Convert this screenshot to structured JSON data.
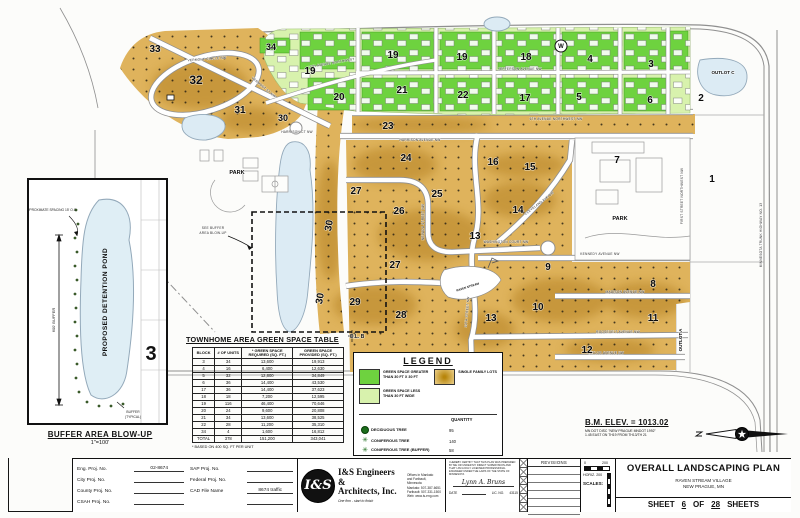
{
  "colors": {
    "gold": "#dfb35c",
    "gold_dark": "#b07d1a",
    "green": "#6ed23f",
    "light_green": "#d8f2ad",
    "pond": "#dcebf4",
    "street_casing": "#8f8f8f"
  },
  "map": {
    "block_labels": [
      {
        "t": "33",
        "x": 155,
        "y": 52
      },
      {
        "t": "32",
        "x": 196,
        "y": 84,
        "s": 12
      },
      {
        "t": "31",
        "x": 240,
        "y": 113
      },
      {
        "t": "30",
        "x": 283,
        "y": 121,
        "s": 9
      },
      {
        "t": "34",
        "x": 271,
        "y": 50,
        "s": 9
      },
      {
        "t": "19",
        "x": 310,
        "y": 74
      },
      {
        "t": "20",
        "x": 339,
        "y": 100
      },
      {
        "t": "21",
        "x": 402,
        "y": 93
      },
      {
        "t": "22",
        "x": 463,
        "y": 98
      },
      {
        "t": "23",
        "x": 388,
        "y": 129
      },
      {
        "t": "19",
        "x": 393,
        "y": 58
      },
      {
        "t": "19",
        "x": 462,
        "y": 60
      },
      {
        "t": "18",
        "x": 526,
        "y": 60
      },
      {
        "t": "4",
        "x": 590,
        "y": 62
      },
      {
        "t": "3",
        "x": 651,
        "y": 67
      },
      {
        "t": "17",
        "x": 525,
        "y": 101
      },
      {
        "t": "5",
        "x": 579,
        "y": 100
      },
      {
        "t": "6",
        "x": 650,
        "y": 103
      },
      {
        "t": "2",
        "x": 701,
        "y": 101
      },
      {
        "t": "OUTLOT C",
        "x": 723,
        "y": 74,
        "s": 4.5
      },
      {
        "t": "24",
        "x": 406,
        "y": 161
      },
      {
        "t": "16",
        "x": 493,
        "y": 165
      },
      {
        "t": "15",
        "x": 530,
        "y": 170
      },
      {
        "t": "27",
        "x": 356,
        "y": 194
      },
      {
        "t": "25",
        "x": 437,
        "y": 197
      },
      {
        "t": "26",
        "x": 399,
        "y": 214
      },
      {
        "t": "14",
        "x": 518,
        "y": 213
      },
      {
        "t": "7",
        "x": 617,
        "y": 163
      },
      {
        "t": "1",
        "x": 712,
        "y": 182
      },
      {
        "t": "13",
        "x": 475,
        "y": 239
      },
      {
        "t": "30",
        "x": 332,
        "y": 226,
        "r": -80
      },
      {
        "t": "27",
        "x": 395,
        "y": 268
      },
      {
        "t": "9",
        "x": 548,
        "y": 270
      },
      {
        "t": "29",
        "x": 355,
        "y": 305
      },
      {
        "t": "28",
        "x": 401,
        "y": 318
      },
      {
        "t": "30",
        "x": 323,
        "y": 299,
        "r": -80
      },
      {
        "t": "13",
        "x": 491,
        "y": 321
      },
      {
        "t": "10",
        "x": 538,
        "y": 310
      },
      {
        "t": "12",
        "x": 587,
        "y": 353
      },
      {
        "t": "8",
        "x": 653,
        "y": 287
      },
      {
        "t": "11",
        "x": 653,
        "y": 321
      },
      {
        "t": "OUTLOT A",
        "x": 682,
        "y": 340,
        "r": -90,
        "s": 4.5
      },
      {
        "t": "PARK",
        "x": 237,
        "y": 174,
        "s": 5.5
      },
      {
        "t": "PARK",
        "x": 620,
        "y": 220,
        "s": 5.5
      },
      {
        "t": "O.L. B",
        "x": 357,
        "y": 338,
        "s": 5
      },
      {
        "t": "RAVEN STREAM",
        "x": 468,
        "y": 288,
        "s": 3,
        "r": -18
      },
      {
        "t": "W",
        "x": 561,
        "y": 48,
        "s": 6
      }
    ],
    "street_labels": [
      {
        "t": "VERMONT CIRCLE NW",
        "x": 207,
        "y": 60,
        "r": -4
      },
      {
        "t": "VERMONT ST NW",
        "x": 263,
        "y": 88,
        "r": 40
      },
      {
        "t": "7TH AVENUE NORTHWEST",
        "x": 332,
        "y": 64,
        "r": -10
      },
      {
        "t": "JEFFERSON AVENUE NW",
        "x": 520,
        "y": 70
      },
      {
        "t": "6TH AVENUE NORTHWEST NW",
        "x": 556,
        "y": 120
      },
      {
        "t": "HARRISON AVENUE NW",
        "x": 420,
        "y": 141
      },
      {
        "t": "HARRISON CT NW",
        "x": 297,
        "y": 133
      },
      {
        "t": "NEVADA STREET NW",
        "x": 424,
        "y": 222,
        "r": -90
      },
      {
        "t": "CLEVELAND AVE NW",
        "x": 540,
        "y": 204,
        "r": -38
      },
      {
        "t": "WASHINGTON COURT NW",
        "x": 506,
        "y": 243
      },
      {
        "t": "KENNEDY AVENUE NW",
        "x": 600,
        "y": 255
      },
      {
        "t": "MADISON AVENUE NW",
        "x": 625,
        "y": 293
      },
      {
        "t": "ROOSEVELT AVENUE NW",
        "x": 618,
        "y": 333
      },
      {
        "t": "TAYLOR AVENUE NW",
        "x": 606,
        "y": 354
      },
      {
        "t": "FIRST STREET NORTHWEST NW",
        "x": 683,
        "y": 196,
        "r": -90
      },
      {
        "t": "MINNESOTA TRUNK HIGHWAY NO. 13",
        "x": 762,
        "y": 235,
        "r": -90
      },
      {
        "t": "10TH STREET NW",
        "x": 468,
        "y": 312,
        "r": -85
      },
      {
        "t": "SEE BUFFER",
        "x": 213,
        "y": 229
      },
      {
        "t": "AREA BLOW-UP",
        "x": 213,
        "y": 234
      }
    ]
  },
  "blowup": {
    "title": "BUFFER AREA BLOW-UP",
    "scale": "1\"=100'",
    "pond_label": "PROPOSED DETENTION POND",
    "spacing_label": "APPROXIMATE SPACING 15' O.C.",
    "dim_label": "600' BUFFER",
    "buffer_label_1": "BUFFER",
    "buffer_label_2": "(TYPICAL)",
    "block_number": "3"
  },
  "table": {
    "title": "TOWNHOME AREA GREEN SPACE TABLE",
    "headers": [
      "BLOCK",
      "# OF UNITS",
      "* GREEN SPACE REQUIRED (SQ. FT.)",
      "GREEN SPACE PROVIDED (SQ. FT.)"
    ],
    "rows": [
      [
        "3",
        "34",
        "13,600",
        "19,913"
      ],
      [
        "4",
        "16",
        "6,400",
        "12,630"
      ],
      [
        "5",
        "32",
        "12,800",
        "34,849"
      ],
      [
        "6",
        "36",
        "14,400",
        "43,530"
      ],
      [
        "17",
        "36",
        "14,400",
        "37,623"
      ],
      [
        "18",
        "18",
        "7,200",
        "12,595"
      ],
      [
        "19",
        "116",
        "46,400",
        "70,646"
      ],
      [
        "20",
        "24",
        "9,600",
        "20,808"
      ],
      [
        "21",
        "34",
        "13,600",
        "38,525"
      ],
      [
        "22",
        "28",
        "11,200",
        "35,310"
      ],
      [
        "34",
        "4",
        "1,600",
        "16,812"
      ],
      [
        "TOTAL",
        "378",
        "151,200",
        "343,041"
      ]
    ],
    "footnote": "* BASED ON 400 SQ. FT PER UNIT"
  },
  "legend": {
    "title": "LEGEND",
    "items": [
      {
        "icon": "green-space-swatch",
        "line1": "GREEN SPACE GREATER",
        "line2": "THAN 30 FT X 30 FT"
      },
      {
        "icon": "light-green-space-swatch",
        "line1": "GREEN SPACE LESS",
        "line2": "THAN 30 FT WIDE"
      },
      {
        "icon": "single-family-swatch",
        "line1": "SINGLE FAMILY LOTS",
        "line2": ""
      }
    ],
    "quantity_header": "QUANTITY",
    "tree_items": [
      {
        "icon": "deciduous-tree-icon",
        "glyph": "",
        "label": "DECIDUOUS TREE",
        "qty": "95"
      },
      {
        "icon": "coniferous-tree-icon",
        "glyph": "✳",
        "label": "CONIFEROUS TREE",
        "qty": "140"
      },
      {
        "icon": "coniferous-buffer-tree-icon",
        "glyph": "✳",
        "label": "CONIFEROUS TREE (BUFFER)",
        "qty": "58"
      }
    ]
  },
  "bm_note": {
    "title": "B.M. ELEV. = 1013.02",
    "line1": "MN DOT DISC \"NEW PRAGUE MNDOT 1992\"",
    "line2": "1.45 EAST ON TH19 FROM TH13/TH 21"
  },
  "titleblock": {
    "proj": {
      "rows": [
        {
          "l1": "Eng. Proj. No.",
          "v1": "02-8674",
          "l2": "SAP Proj. No.",
          "v2": ""
        },
        {
          "l1": "City Proj. No.",
          "v1": "",
          "l2": "Federal Proj. No.",
          "v2": ""
        },
        {
          "l1": "County Proj. No.",
          "v1": "",
          "l2": "CAD File Name",
          "v2": "8674 traffic"
        },
        {
          "l1": "CSAH Proj. No.",
          "v1": "",
          "l2": "",
          "v2": ""
        }
      ]
    },
    "firm": {
      "logo_text": "I&S",
      "name_line1": "I&S Engineers &",
      "name_line2": "Architects, Inc.",
      "tagline": "One firm - start to finish",
      "info_lines": [
        "Offices in Mankato",
        "and Faribault, Minnesota",
        "Mankato: 507-387-6651",
        "Faribault: 507-331-1500",
        "Web: www.is-eng.com"
      ]
    },
    "cert": {
      "statement": "I hereby certify that this plan was prepared by me or under my direct supervision and that I am a duly Licensed Professional Engineer under the laws of the State of Minnesota",
      "signer": "Lynn A. Bruns",
      "date_label": "DATE",
      "lic_label": "LIC. NO.",
      "lic_no": "43115"
    },
    "revisions_header": "REVISIONS",
    "scales": {
      "label": "SCALES:",
      "zero": "0",
      "max": "200",
      "horiz_label": "HORIZ.",
      "horiz_value": "200"
    },
    "title": "OVERALL LANDSCAPING PLAN",
    "project_line1": "RAVEN STREAM VILLAGE",
    "project_line2": "NEW PRAGUE, MN",
    "sheet_label": "SHEET",
    "sheet_no": "6",
    "of_label": "OF",
    "sheet_total": "28",
    "sheets_label": "SHEETS"
  }
}
